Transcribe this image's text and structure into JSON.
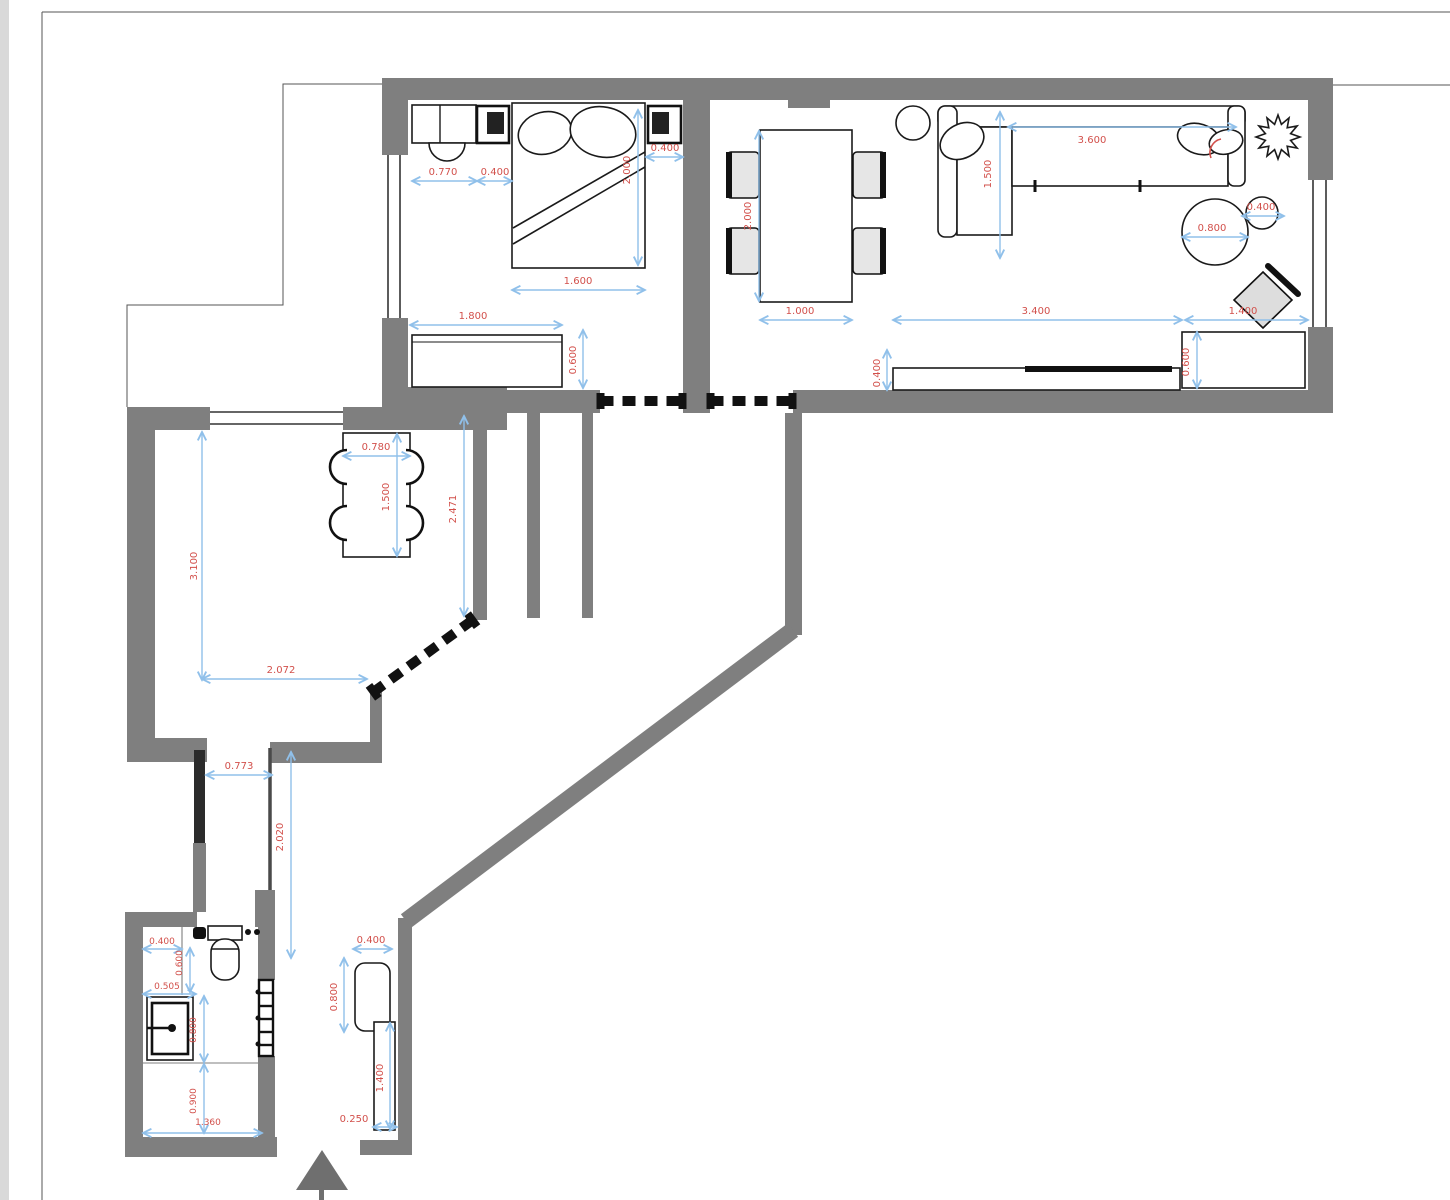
{
  "drawing": {
    "type": "apartment floor plan",
    "colors": {
      "wall": "#7f7f7f",
      "outline": "#1a1a1a",
      "dimension_line": "#90c0ea",
      "dimension_text": "#d2504b",
      "background": "#ffffff"
    }
  },
  "dimensions": {
    "bedroom": {
      "d770": "0.770",
      "d400a": "0.400",
      "d400b": "0.400",
      "d2000": "2.000",
      "d1600": "1.600",
      "d1800": "1.800",
      "d600": "0.600"
    },
    "living": {
      "d2000": "2.000",
      "d1000": "1.000",
      "d1500": "1.500",
      "d3600": "3.600",
      "d800": "0.800",
      "d400": "0.400",
      "d3400": "3.400",
      "d1400": "1.400",
      "d400tv": "0.400",
      "d600": "0.600"
    },
    "kitchen": {
      "d780": "0.780",
      "d1500": "1.500",
      "d3100": "3.100",
      "d2072": "2.072",
      "d2471": "2.471"
    },
    "hall": {
      "d773": "0.773",
      "d2020": "2.020"
    },
    "entry": {
      "d400": "0.400",
      "d800": "0.800",
      "d1400": "1.400",
      "d250": "0.250"
    },
    "bathroom": {
      "d400": "0.400",
      "d600": "0.600",
      "d505": "0.505",
      "d800": "0.800",
      "d900": "0.900",
      "d1360": "1.360"
    }
  }
}
